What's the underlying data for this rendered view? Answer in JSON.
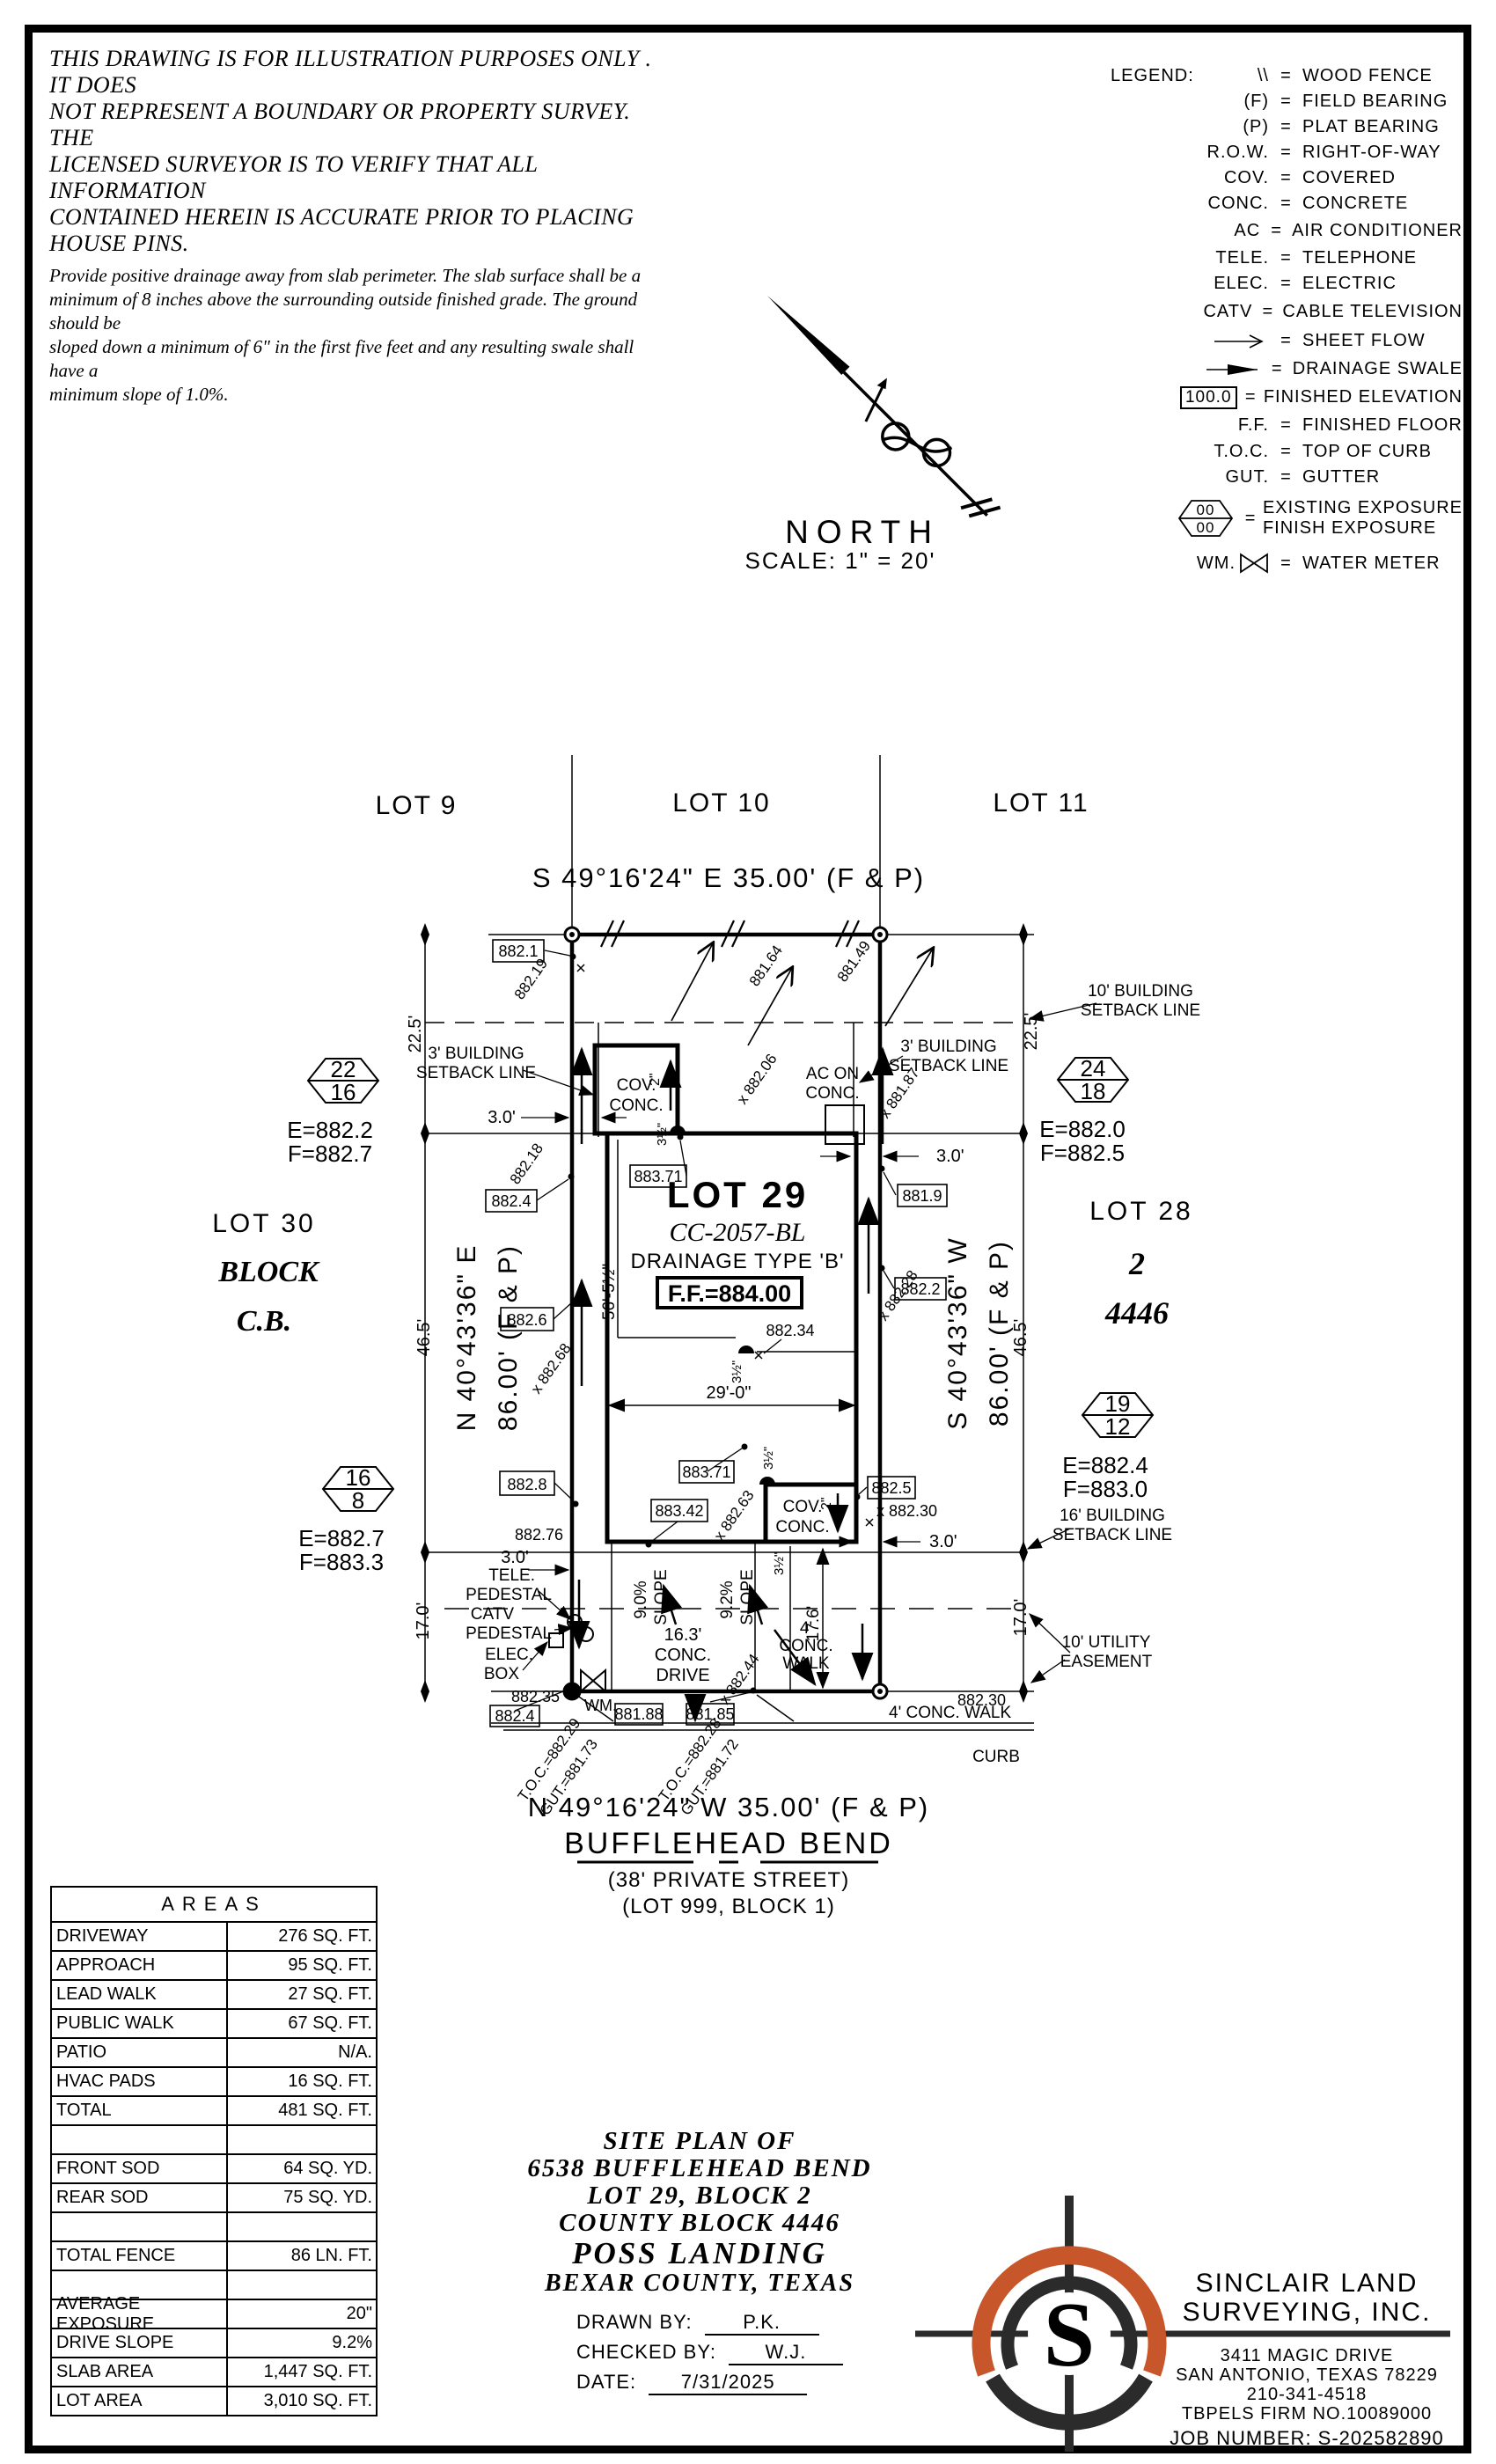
{
  "disclaimer": {
    "p1": [
      "THIS DRAWING IS FOR ILLUSTRATION PURPOSES ONLY . IT DOES",
      "NOT REPRESENT A BOUNDARY OR PROPERTY SURVEY. THE",
      "LICENSED SURVEYOR IS TO VERIFY THAT ALL INFORMATION",
      "CONTAINED HEREIN IS ACCURATE PRIOR TO PLACING HOUSE PINS."
    ],
    "p2": [
      "Provide positive drainage away from slab perimeter. The slab surface shall be a",
      "minimum of 8 inches above the surrounding outside finished grade. The ground should be",
      "sloped down a minimum of 6\" in the first five feet and any resulting swale shall have a",
      "minimum slope of 1.0%."
    ]
  },
  "legend": {
    "title": "LEGEND:",
    "eq": "=",
    "rows": [
      {
        "sym": "\\\\",
        "label": "WOOD FENCE"
      },
      {
        "sym": "(F)",
        "label": "FIELD BEARING"
      },
      {
        "sym": "(P)",
        "label": "PLAT BEARING"
      },
      {
        "sym": "R.O.W.",
        "label": "RIGHT-OF-WAY"
      },
      {
        "sym": "COV.",
        "label": "COVERED"
      },
      {
        "sym": "CONC.",
        "label": "CONCRETE"
      },
      {
        "sym": "AC",
        "label": "AIR CONDITIONER"
      },
      {
        "sym": "TELE.",
        "label": "TELEPHONE"
      },
      {
        "sym": "ELEC.",
        "label": "ELECTRIC"
      },
      {
        "sym": "CATV",
        "label": "CABLE TELEVISION"
      },
      {
        "sym": "",
        "label": "SHEET FLOW"
      },
      {
        "sym": "",
        "label": "DRAINAGE SWALE"
      },
      {
        "sym": "100.0",
        "label": "FINISHED ELEVATION"
      },
      {
        "sym": "F.F.",
        "label": "FINISHED FLOOR"
      },
      {
        "sym": "T.O.C.",
        "label": "TOP OF CURB"
      },
      {
        "sym": "GUT.",
        "label": "GUTTER"
      },
      {
        "sym": "00",
        "sym2": "00",
        "label": "EXISTING EXPOSURE",
        "label2": "FINISH EXPOSURE"
      },
      {
        "sym": "WM.",
        "label": "WATER METER"
      }
    ]
  },
  "north": {
    "label": "NORTH",
    "scale": "SCALE: 1\" = 20'"
  },
  "plan": {
    "lot9": "LOT 9",
    "lot10": "LOT 10",
    "lot11": "LOT 11",
    "brg_top": "S 49°16'24\" E 35.00' (F & P)",
    "brg_bottom": "N 49°16'24\" W 35.00' (F & P)",
    "street": "BUFFLEHEAD BEND",
    "street_sub1": "(38' PRIVATE STREET)",
    "street_sub2": "(LOT 999, BLOCK 1)",
    "lot30": "LOT 30",
    "block_word": "BLOCK",
    "cb_word": "C.B.",
    "lot28": "LOT 28",
    "block_num": "2",
    "county_block": "4446",
    "brg_left_dir": "N 40°43'36\" E",
    "brg_left_len": "86.00' (F & P)",
    "brg_right_dir": "S 40°43'36\" W",
    "brg_right_len": "86.00' (F & P)",
    "lot29": "LOT 29",
    "cc": "CC-2057-BL",
    "drainage": "DRAINAGE TYPE 'B'",
    "ff": "F.F.=884.00",
    "dim_225l": "22.5'",
    "dim_225r": "22.5'",
    "dim_465l": "46.5'",
    "dim_465r": "46.5'",
    "dim_170l": "17.0'",
    "dim_170r": "17.0'",
    "dim_176": "17.6'",
    "dim_56": "56'-5½\"",
    "dim_29": "29'-0\"",
    "dim_30_nw": "3.0'",
    "dim_30_ne": "3.0'",
    "dim_30_se": "3.0'",
    "dim_30_sw": "3.0'",
    "dim_35a": "3½\"",
    "dim_35b": "3½\"",
    "dim_35c": "3½\"",
    "dim_35d": "3½\"",
    "dim_2a": "2\"",
    "dim_2b": "2\"",
    "sb3_1": "3' BUILDING",
    "sb3_2": "SETBACK LINE",
    "sb3r_1": "3' BUILDING",
    "sb3r_2": "SETBACK LINE",
    "sb10_1": "10' BUILDING",
    "sb10_2": "SETBACK LINE",
    "sb16_1": "16' BUILDING",
    "sb16_2": "SETBACK LINE",
    "ue_1": "10' UTILITY",
    "ue_2": "EASEMENT",
    "ac_1": "AC ON",
    "ac_2": "CONC.",
    "cov_r1": "COV.",
    "cov_r2": "CONC.",
    "cov_f1": "COV.",
    "cov_f2": "CONC.",
    "tele": "TELE.",
    "ped1": "PEDESTAL",
    "catv": "CATV",
    "ped2": "PEDESTAL",
    "elec": "ELEC.",
    "elec_box": "BOX",
    "wm": "WM.",
    "slope1": "9.0%",
    "slope1w": "SLOPE",
    "slope2": "9.2%",
    "slope2w": "SLOPE",
    "drive_1": "16.3'",
    "drive_2": "CONC.",
    "drive_3": "DRIVE",
    "walk_1": "4'",
    "walk_2": "CONC.",
    "walk_3": "WALK",
    "walk_long": "4' CONC. WALK",
    "curb": "CURB",
    "toc1": "T.O.C.=882.29",
    "gut1": "GUT.=881.73",
    "toc2": "T.O.C.=882.28",
    "gut2": "GUT.=881.72",
    "be_8821": "882.1",
    "be_8824": "882.4",
    "be_8826": "882.6",
    "be_8828": "882.8",
    "be_8824b": "882.4",
    "be_8819": "881.9",
    "be_8822": "882.2",
    "be_8825": "882.5",
    "be_88371a": "883.71",
    "be_88371b": "883.71",
    "be_88342": "883.42",
    "be_88188": "881.88",
    "be_88185": "881.85",
    "sp_88276": "882.76",
    "sp_88235": "882.35",
    "sp_88230a": "x 882.30",
    "sp_88230b": "882.30",
    "sp_88234": "882.34",
    "sp_88219": "882.19",
    "sp_88218": "882.18",
    "sp_88268": "x 882.68",
    "sp_88164": "881.64",
    "sp_88149": "881.49",
    "sp_88187": "x 881.87",
    "sp_88206": "x 882.06",
    "sp_88228": "x 882.28",
    "sp_88263": "x 882.63",
    "sp_88244": "x 882.44",
    "hex1": {
      "top": "22",
      "bot": "16",
      "e": "E=882.2",
      "f": "F=882.7"
    },
    "hex2": {
      "top": "24",
      "bot": "18",
      "e": "E=882.0",
      "f": "F=882.5"
    },
    "hex3": {
      "top": "16",
      "bot": "8",
      "e": "E=882.7",
      "f": "F=883.3"
    },
    "hex4": {
      "top": "19",
      "bot": "12",
      "e": "E=882.4",
      "f": "F=883.0"
    }
  },
  "areas": {
    "title": "AREAS",
    "rows": [
      {
        "label": "DRIVEWAY",
        "value": "276 SQ. FT."
      },
      {
        "label": "APPROACH",
        "value": "95 SQ. FT."
      },
      {
        "label": "LEAD WALK",
        "value": "27 SQ. FT."
      },
      {
        "label": "PUBLIC WALK",
        "value": "67 SQ. FT."
      },
      {
        "label": "PATIO",
        "value": "N/A."
      },
      {
        "label": "HVAC PADS",
        "value": "16 SQ. FT."
      },
      {
        "label": "TOTAL",
        "value": "481 SQ. FT."
      },
      {
        "label": "",
        "value": ""
      },
      {
        "label": "FRONT SOD",
        "value": "64 SQ. YD."
      },
      {
        "label": "REAR SOD",
        "value": "75 SQ. YD."
      },
      {
        "label": "",
        "value": ""
      },
      {
        "label": "TOTAL FENCE",
        "value": "86 LN. FT."
      },
      {
        "label": "",
        "value": ""
      },
      {
        "label": "AVERAGE EXPOSURE",
        "value": "20\""
      },
      {
        "label": "DRIVE SLOPE",
        "value": "9.2%"
      },
      {
        "label": "SLAB AREA",
        "value": "1,447 SQ. FT."
      },
      {
        "label": "LOT AREA",
        "value": "3,010 SQ. FT."
      }
    ]
  },
  "title_block": {
    "l1": "SITE PLAN OF",
    "l2": "6538 BUFFLEHEAD BEND",
    "l3": "LOT 29, BLOCK 2",
    "l4": "COUNTY BLOCK 4446",
    "l5": "POSS LANDING",
    "l6": "BEXAR COUNTY, TEXAS",
    "drawn_label": "DRAWN BY:",
    "drawn": "P.K.",
    "checked_label": "CHECKED BY:",
    "checked": "W.J.",
    "date_label": "DATE:",
    "date": "7/31/2025"
  },
  "company": {
    "name1": "SINCLAIR LAND",
    "name2": "SURVEYING, INC.",
    "addr1": "3411 MAGIC DRIVE",
    "addr2": "SAN ANTONIO, TEXAS 78229",
    "phone": "210-341-4518",
    "firm": "TBPELS FIRM NO.10089000",
    "job": "JOB NUMBER: S-202582890",
    "logo_letter": "S",
    "orange": "#C8562B"
  }
}
